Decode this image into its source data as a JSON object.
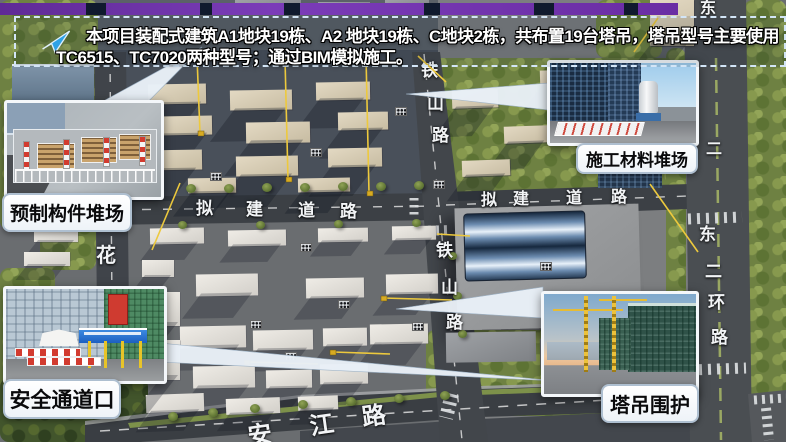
{
  "banner": {
    "line1": "本项目装配式建筑A1地块19栋、A2 地块19栋、C地块2栋，共布置19台塔吊，塔吊型号主要使用",
    "line2": "TC6515、TC7020两种型号；通过BIM模拟施工。",
    "arrow_icon": "paper-plane-arrow",
    "border_color": "#d3e5f6",
    "top_bar_color": "#6a2da4"
  },
  "callouts": [
    {
      "id": "precast-yard",
      "label": "预制构件堆场"
    },
    {
      "id": "material-yard",
      "label": "施工材料堆场"
    },
    {
      "id": "safety-passage",
      "label": "安全通道口"
    },
    {
      "id": "crane-enclosure",
      "label": "塔吊围护"
    }
  ],
  "colors": {
    "crane_yellow": "#edc93d",
    "road_label": "#f2f4f6",
    "accent_purple": "#6a2da4"
  },
  "scene": {
    "road_labels": [
      [
        "铁",
        421,
        62,
        17,
        0
      ],
      [
        "山",
        427,
        95,
        17,
        0
      ],
      [
        "路",
        432,
        127,
        17,
        0
      ],
      [
        "铁",
        436,
        242,
        17,
        0
      ],
      [
        "山",
        441,
        279,
        17,
        0
      ],
      [
        "路",
        446,
        314,
        17,
        0
      ],
      [
        "拟",
        196,
        200,
        17,
        0
      ],
      [
        "建",
        246,
        201,
        17,
        0
      ],
      [
        "道",
        298,
        202,
        17,
        0
      ],
      [
        "路",
        340,
        203,
        17,
        0
      ],
      [
        "拟",
        481,
        193,
        16,
        0
      ],
      [
        "建",
        513,
        192,
        16,
        0
      ],
      [
        "道",
        566,
        191,
        16,
        0
      ],
      [
        "路",
        611,
        190,
        16,
        0
      ],
      [
        "冲",
        100,
        142,
        19,
        0
      ],
      [
        "花",
        96,
        246,
        20,
        0
      ],
      [
        "东",
        700,
        1,
        16,
        0
      ],
      [
        "二",
        706,
        142,
        16,
        0
      ],
      [
        "东",
        699,
        226,
        17,
        0
      ],
      [
        "二",
        705,
        263,
        17,
        0
      ],
      [
        "环",
        708,
        294,
        17,
        0
      ],
      [
        "路",
        711,
        329,
        17,
        0
      ],
      [
        "安",
        248,
        424,
        24,
        -8
      ],
      [
        "江",
        310,
        414,
        24,
        -8
      ],
      [
        "路",
        362,
        405,
        24,
        -8
      ]
    ],
    "rects": [
      [
        "gA",
        95,
        0,
        345,
        54,
        0
      ],
      [
        "gB",
        93,
        50,
        350,
        148,
        0
      ],
      [
        "gC",
        93,
        220,
        362,
        202,
        0
      ],
      [
        "gD",
        438,
        0,
        250,
        442,
        0
      ],
      [
        "f",
        0,
        0,
        98,
        110,
        0
      ],
      [
        "f",
        0,
        100,
        60,
        130,
        0
      ],
      [
        "f",
        40,
        170,
        56,
        100,
        0
      ],
      [
        "f",
        0,
        268,
        55,
        125,
        0
      ],
      [
        "fd",
        0,
        378,
        148,
        64,
        0
      ],
      [
        "f",
        428,
        58,
        252,
        136,
        0
      ],
      [
        "f",
        596,
        0,
        66,
        58,
        0
      ],
      [
        "f",
        666,
        48,
        20,
        394,
        0
      ],
      [
        "f",
        744,
        0,
        42,
        442,
        0
      ],
      [
        "f",
        426,
        330,
        200,
        86,
        0
      ],
      [
        "f",
        600,
        384,
        92,
        56,
        0
      ],
      [
        "gb",
        235,
        0,
        66,
        13,
        0
      ],
      [
        "gb",
        318,
        2,
        52,
        11,
        0
      ],
      [
        "gb",
        385,
        0,
        44,
        12,
        0
      ],
      [
        "sb",
        12,
        64,
        82,
        38,
        0
      ],
      [
        "nb",
        598,
        126,
        64,
        62,
        0
      ],
      [
        "bb",
        650,
        0,
        44,
        46,
        0
      ],
      [
        "bb",
        148,
        84,
        58,
        20,
        -1
      ],
      [
        "bb",
        230,
        90,
        62,
        20,
        -1
      ],
      [
        "bb",
        316,
        82,
        54,
        18,
        -1
      ],
      [
        "bb",
        160,
        116,
        52,
        19,
        -1
      ],
      [
        "bb",
        246,
        122,
        64,
        21,
        -1
      ],
      [
        "bb",
        338,
        112,
        50,
        18,
        -1
      ],
      [
        "bb",
        142,
        150,
        60,
        20,
        -1
      ],
      [
        "bb",
        236,
        156,
        62,
        20,
        -1
      ],
      [
        "bb",
        328,
        148,
        54,
        19,
        -1
      ],
      [
        "bb",
        188,
        178,
        48,
        15,
        -1
      ],
      [
        "bb",
        298,
        178,
        52,
        14,
        -1
      ],
      [
        "bb",
        452,
        90,
        46,
        18,
        -2
      ],
      [
        "bb",
        504,
        126,
        44,
        17,
        -2
      ],
      [
        "bb",
        462,
        160,
        48,
        16,
        -2
      ],
      [
        "bb",
        540,
        70,
        38,
        15,
        -2
      ],
      [
        "wb",
        150,
        228,
        54,
        16,
        -1
      ],
      [
        "wb",
        228,
        230,
        58,
        16,
        -1
      ],
      [
        "wb",
        318,
        228,
        50,
        14,
        -1
      ],
      [
        "wb",
        392,
        226,
        44,
        14,
        -1
      ],
      [
        "wb",
        142,
        260,
        32,
        17,
        0
      ],
      [
        "wb",
        142,
        298,
        32,
        17,
        0
      ],
      [
        "wb",
        196,
        274,
        62,
        22,
        -1
      ],
      [
        "wb",
        306,
        278,
        58,
        20,
        -1
      ],
      [
        "wb",
        386,
        274,
        52,
        20,
        -1
      ],
      [
        "wb",
        180,
        326,
        66,
        22,
        -1
      ],
      [
        "wb",
        253,
        330,
        60,
        20,
        -1
      ],
      [
        "wb",
        323,
        328,
        44,
        18,
        -1
      ],
      [
        "wb",
        370,
        324,
        58,
        20,
        -1
      ],
      [
        "wb",
        193,
        366,
        62,
        22,
        -1
      ],
      [
        "wb",
        266,
        370,
        46,
        18,
        -1
      ],
      [
        "wb",
        320,
        364,
        48,
        20,
        -1
      ],
      [
        "wb",
        146,
        394,
        58,
        18,
        -2
      ],
      [
        "wb",
        226,
        398,
        54,
        16,
        -2
      ],
      [
        "wb",
        298,
        396,
        40,
        14,
        -2
      ],
      [
        "wb",
        34,
        228,
        44,
        14,
        0
      ],
      [
        "wb",
        24,
        252,
        46,
        14,
        0
      ],
      [
        "wb",
        162,
        292,
        18,
        34,
        0
      ],
      [
        "wb",
        162,
        340,
        18,
        40,
        0
      ],
      [
        "bigb",
        456,
        206,
        184,
        122,
        -1.5
      ],
      [
        "roof",
        464,
        212,
        120,
        66,
        -1.5
      ],
      [
        "gb2",
        586,
        298,
        60,
        42,
        -1
      ],
      [
        "gb",
        446,
        332,
        90,
        30,
        -1
      ],
      [
        "gb2",
        540,
        338,
        84,
        30,
        -1
      ],
      [
        "tr",
        148,
        185,
        10,
        9,
        0
      ],
      [
        "tr",
        186,
        184,
        10,
        9,
        0
      ],
      [
        "tr",
        224,
        184,
        10,
        9,
        0
      ],
      [
        "tr",
        262,
        183,
        10,
        9,
        0
      ],
      [
        "tr",
        300,
        183,
        10,
        9,
        0
      ],
      [
        "tr",
        338,
        182,
        10,
        9,
        0
      ],
      [
        "tr",
        376,
        182,
        10,
        9,
        0
      ],
      [
        "tr",
        414,
        181,
        10,
        9,
        0
      ],
      [
        "tr",
        178,
        221,
        9,
        8,
        0
      ],
      [
        "tr",
        256,
        221,
        9,
        8,
        0
      ],
      [
        "tr",
        334,
        220,
        9,
        8,
        0
      ],
      [
        "tr",
        412,
        219,
        9,
        8,
        0
      ],
      [
        "tr",
        448,
        252,
        9,
        8,
        0
      ],
      [
        "tr",
        453,
        292,
        9,
        8,
        0
      ],
      [
        "tr",
        458,
        330,
        9,
        8,
        0
      ],
      [
        "tr",
        168,
        412,
        10,
        9,
        0
      ],
      [
        "tr",
        208,
        408,
        10,
        9,
        0
      ],
      [
        "tr",
        250,
        404,
        10,
        9,
        0
      ],
      [
        "tr",
        298,
        400,
        10,
        9,
        0
      ],
      [
        "tr",
        346,
        397,
        10,
        9,
        0
      ],
      [
        "tr",
        394,
        394,
        10,
        9,
        0
      ],
      [
        "tr",
        440,
        391,
        10,
        9,
        0
      ],
      [
        "mk",
        395,
        107,
        10,
        7,
        0
      ],
      [
        "mk",
        310,
        148,
        10,
        7,
        0
      ],
      [
        "mk",
        210,
        172,
        10,
        7,
        0
      ],
      [
        "mk",
        433,
        180,
        10,
        7,
        0
      ],
      [
        "mk",
        300,
        243,
        10,
        7,
        0
      ],
      [
        "mk",
        338,
        300,
        10,
        7,
        0
      ],
      [
        "mk",
        250,
        320,
        10,
        7,
        0
      ],
      [
        "mk",
        412,
        322,
        10,
        7,
        0
      ],
      [
        "mk",
        285,
        352,
        10,
        7,
        0
      ],
      [
        "mk",
        540,
        262,
        10,
        7,
        0
      ],
      [
        "mk",
        668,
        318,
        10,
        7,
        0
      ]
    ],
    "crane_lines": [
      [
        197,
        57,
        200,
        133
      ],
      [
        285,
        59,
        288,
        179
      ],
      [
        366,
        56,
        369,
        193
      ],
      [
        180,
        183,
        152,
        250
      ],
      [
        650,
        184,
        698,
        252
      ],
      [
        383,
        298,
        452,
        300
      ],
      [
        333,
        352,
        390,
        354
      ],
      [
        247,
        362,
        318,
        364
      ],
      [
        437,
        234,
        470,
        236
      ],
      [
        418,
        56,
        446,
        82
      ],
      [
        634,
        52,
        658,
        18
      ]
    ],
    "crane_masts": [
      [
        381,
        296
      ],
      [
        330,
        350
      ],
      [
        244,
        360
      ],
      [
        198,
        131
      ],
      [
        286,
        177
      ],
      [
        367,
        191
      ]
    ],
    "notches": [
      [
        86,
        20
      ],
      [
        200,
        12
      ],
      [
        284,
        16
      ],
      [
        424,
        16
      ],
      [
        534,
        20
      ],
      [
        624,
        14
      ]
    ]
  }
}
